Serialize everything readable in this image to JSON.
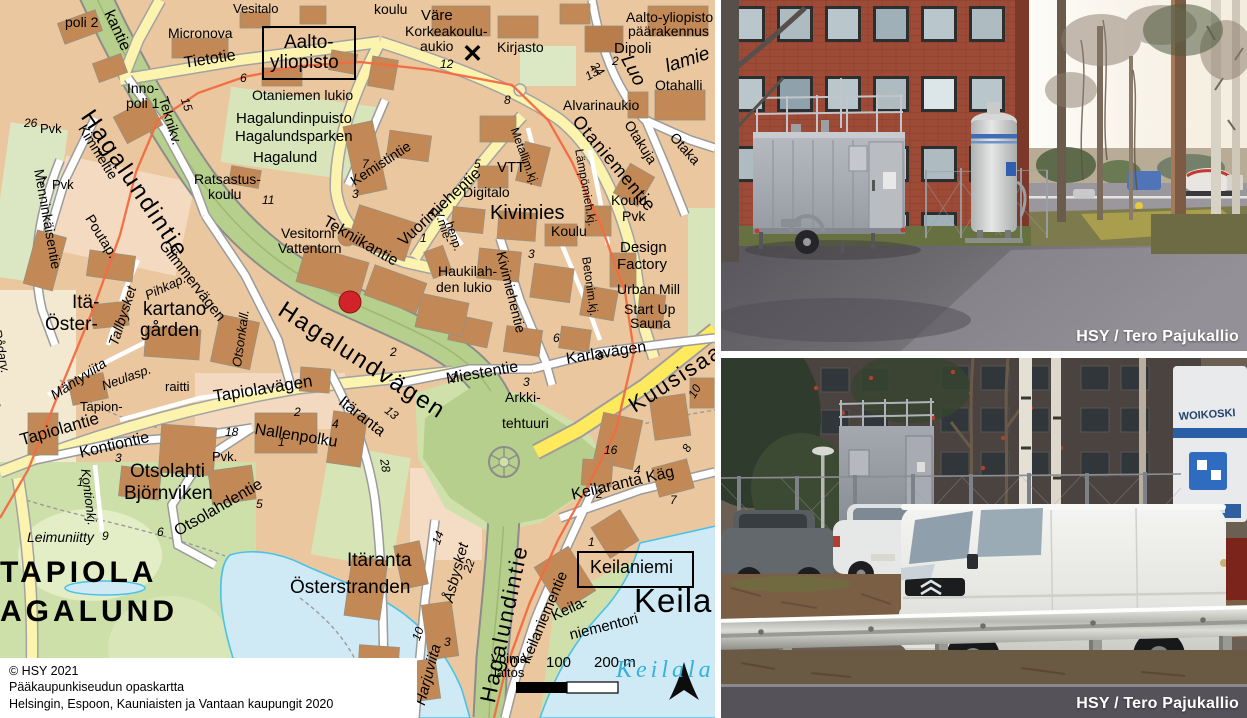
{
  "map": {
    "copyright_lines": [
      "© HSY 2021",
      "Pääkaupunkiseudun opaskartta",
      "Helsingin, Espoon, Kauniaisten ja Vantaan kaupungit 2020"
    ],
    "scale_bar": {
      "tick0": "0",
      "tick1": "100",
      "tick2": "200 m"
    },
    "marker_color": "#d2232a",
    "route_color": "#f26a41",
    "boxes": [
      {
        "x": 262,
        "y": 26,
        "w": 90,
        "h": 50
      },
      {
        "x": 577,
        "y": 551,
        "w": 113,
        "h": 33
      }
    ],
    "labels": [
      {
        "t": "poli 2",
        "x": 65,
        "y": 15,
        "s": 14
      },
      {
        "t": "Vesitalo",
        "x": 233,
        "y": 2,
        "s": 13
      },
      {
        "t": "kantie",
        "x": 115,
        "y": 8,
        "s": 16,
        "r": 65
      },
      {
        "t": "Micronova",
        "x": 168,
        "y": 26,
        "s": 14
      },
      {
        "t": "Tietotie",
        "x": 183,
        "y": 56,
        "s": 16,
        "r": -9
      },
      {
        "t": "6",
        "x": 240,
        "y": 72,
        "s": 12,
        "i": 1
      },
      {
        "t": "Aalto-",
        "x": 284,
        "y": 33,
        "s": 19
      },
      {
        "t": "yliopisto",
        "x": 270,
        "y": 53,
        "s": 19
      },
      {
        "t": "koulu",
        "x": 374,
        "y": 2,
        "s": 14
      },
      {
        "t": "Väre",
        "x": 421,
        "y": 8,
        "s": 15
      },
      {
        "t": "Korkeakoulu-",
        "x": 405,
        "y": 24,
        "s": 14
      },
      {
        "t": "aukio",
        "x": 420,
        "y": 39,
        "s": 14
      },
      {
        "t": "Kirjasto",
        "x": 497,
        "y": 40,
        "s": 14
      },
      {
        "t": "12",
        "x": 440,
        "y": 58,
        "s": 12,
        "i": 1
      },
      {
        "t": "✕",
        "x": 462,
        "y": 42,
        "s": 25,
        "b": 1
      },
      {
        "t": "Aalto-yliopisto",
        "x": 626,
        "y": 10,
        "s": 14
      },
      {
        "t": "päärakennus",
        "x": 628,
        "y": 24,
        "s": 14
      },
      {
        "t": "Dipoli",
        "x": 614,
        "y": 41,
        "s": 15
      },
      {
        "t": "Luo",
        "x": 634,
        "y": 52,
        "s": 19,
        "i": 1,
        "r": 62
      },
      {
        "t": "lamie",
        "x": 663,
        "y": 58,
        "s": 19,
        "i": 1,
        "r": -18
      },
      {
        "t": "13",
        "x": 583,
        "y": 72,
        "s": 12,
        "i": 1,
        "r": -30
      },
      {
        "t": "24",
        "x": 598,
        "y": 60,
        "s": 12,
        "i": 1,
        "r": 50
      },
      {
        "t": "2",
        "x": 612,
        "y": 55,
        "s": 12,
        "i": 1
      },
      {
        "t": "Otahalli",
        "x": 655,
        "y": 78,
        "s": 14
      },
      {
        "t": "Alvarinaukio",
        "x": 563,
        "y": 98,
        "s": 14
      },
      {
        "t": "Otaniementie",
        "x": 583,
        "y": 112,
        "s": 18,
        "r": 50,
        "ls": 1
      },
      {
        "t": "Otakuja",
        "x": 634,
        "y": 118,
        "s": 14,
        "r": 58
      },
      {
        "t": "Otaka",
        "x": 678,
        "y": 130,
        "s": 14,
        "r": 48
      },
      {
        "t": "Otaniemen lukio",
        "x": 252,
        "y": 88,
        "s": 14
      },
      {
        "t": "Hagalundinpuisto",
        "x": 236,
        "y": 111,
        "s": 15
      },
      {
        "t": "Hagalundsparken",
        "x": 235,
        "y": 129,
        "s": 15
      },
      {
        "t": "Hagalund",
        "x": 253,
        "y": 150,
        "s": 15
      },
      {
        "t": "Inno-",
        "x": 127,
        "y": 81,
        "s": 14
      },
      {
        "t": "poli 1",
        "x": 126,
        "y": 96,
        "s": 14
      },
      {
        "t": "Teknikv.",
        "x": 170,
        "y": 95,
        "s": 14,
        "r": 73
      },
      {
        "t": "15",
        "x": 190,
        "y": 96,
        "s": 12,
        "i": 1,
        "r": 70
      },
      {
        "t": "26",
        "x": 24,
        "y": 117,
        "s": 12,
        "i": 1
      },
      {
        "t": "Pvk",
        "x": 40,
        "y": 122,
        "s": 13
      },
      {
        "t": "Kimmeltie",
        "x": 88,
        "y": 122,
        "s": 14,
        "r": 58
      },
      {
        "t": "Hagalundintie",
        "x": 96,
        "y": 106,
        "s": 24,
        "r": 56,
        "ls": 2
      },
      {
        "t": "7",
        "x": 40,
        "y": 175,
        "s": 12,
        "i": 1
      },
      {
        "t": "Pvk",
        "x": 52,
        "y": 178,
        "s": 13
      },
      {
        "t": "Menninkäisentie",
        "x": 46,
        "y": 168,
        "s": 14,
        "r": 80
      },
      {
        "t": "Poutap.",
        "x": 95,
        "y": 212,
        "s": 14,
        "r": 58
      },
      {
        "t": "Glimmervägen",
        "x": 168,
        "y": 238,
        "s": 15,
        "r": 52
      },
      {
        "t": "Ratsastus-",
        "x": 194,
        "y": 172,
        "s": 14
      },
      {
        "t": "koulu",
        "x": 208,
        "y": 187,
        "s": 14
      },
      {
        "t": "11",
        "x": 262,
        "y": 194,
        "s": 12,
        "i": 1
      },
      {
        "t": "Vesitorni",
        "x": 281,
        "y": 226,
        "s": 14
      },
      {
        "t": "Vattentorn",
        "x": 278,
        "y": 241,
        "s": 14
      },
      {
        "t": "Tekniikantie",
        "x": 328,
        "y": 214,
        "s": 16,
        "r": 30
      },
      {
        "t": "Kemistintie",
        "x": 348,
        "y": 176,
        "s": 14,
        "r": -33
      },
      {
        "t": "Hagalundvägen",
        "x": 287,
        "y": 298,
        "s": 24,
        "r": 33,
        "ls": 2
      },
      {
        "t": "Itä-",
        "x": 72,
        "y": 293,
        "s": 19
      },
      {
        "t": "Öster-",
        "x": 45,
        "y": 315,
        "s": 19
      },
      {
        "t": "kartano",
        "x": 143,
        "y": 300,
        "s": 19
      },
      {
        "t": "gården",
        "x": 140,
        "y": 321,
        "s": 19
      },
      {
        "t": "Tallbysket",
        "x": 106,
        "y": 343,
        "s": 14,
        "r": -72,
        "i": 1
      },
      {
        "t": "Pihkap.",
        "x": 143,
        "y": 290,
        "s": 13,
        "r": -25,
        "i": 1
      },
      {
        "t": "Otsonkall.",
        "x": 230,
        "y": 366,
        "s": 13,
        "r": -82,
        "i": 1
      },
      {
        "t": "Rådarv.",
        "x": 3,
        "y": 328,
        "s": 13,
        "r": 78,
        "i": 1
      },
      {
        "t": "op.",
        "x": 0,
        "y": 392,
        "s": 13,
        "r": 70,
        "i": 1
      },
      {
        "t": "Mäntyviita",
        "x": 48,
        "y": 390,
        "s": 14,
        "r": -33,
        "i": 1
      },
      {
        "t": "Neulasp.",
        "x": 100,
        "y": 380,
        "s": 13,
        "r": -20,
        "i": 1
      },
      {
        "t": "Tapion-",
        "x": 80,
        "y": 400,
        "s": 13
      },
      {
        "t": "raitti",
        "x": 165,
        "y": 380,
        "s": 13
      },
      {
        "t": "Tapiolavägen",
        "x": 212,
        "y": 388,
        "s": 17,
        "r": -9
      },
      {
        "t": "Tapiolantie",
        "x": 18,
        "y": 432,
        "s": 17,
        "r": -16
      },
      {
        "t": "Kontiontie",
        "x": 78,
        "y": 446,
        "s": 16,
        "r": -13
      },
      {
        "t": "Nallenpolku",
        "x": 256,
        "y": 422,
        "s": 16,
        "r": 9
      },
      {
        "t": "2",
        "x": 294,
        "y": 406,
        "s": 12,
        "i": 1
      },
      {
        "t": "4",
        "x": 332,
        "y": 418,
        "s": 12,
        "i": 1
      },
      {
        "t": "1",
        "x": 278,
        "y": 436,
        "s": 12,
        "i": 1
      },
      {
        "t": "18",
        "x": 225,
        "y": 426,
        "s": 12,
        "i": 1
      },
      {
        "t": "Pvk.",
        "x": 212,
        "y": 450,
        "s": 13
      },
      {
        "t": "Otsolahti",
        "x": 130,
        "y": 462,
        "s": 19
      },
      {
        "t": "Björnviken",
        "x": 124,
        "y": 484,
        "s": 19
      },
      {
        "t": "3",
        "x": 115,
        "y": 452,
        "s": 12,
        "i": 1
      },
      {
        "t": "1",
        "x": 77,
        "y": 476,
        "s": 12,
        "i": 1
      },
      {
        "t": "Kontionkj.",
        "x": 92,
        "y": 468,
        "s": 13,
        "r": 83,
        "i": 1
      },
      {
        "t": "6",
        "x": 157,
        "y": 526,
        "s": 12,
        "i": 1
      },
      {
        "t": "9",
        "x": 102,
        "y": 530,
        "s": 12,
        "i": 1
      },
      {
        "t": "5",
        "x": 256,
        "y": 498,
        "s": 12,
        "i": 1
      },
      {
        "t": "Otsolahdentie",
        "x": 172,
        "y": 526,
        "s": 16,
        "r": -30
      },
      {
        "t": "Leimuniitty",
        "x": 27,
        "y": 530,
        "s": 14,
        "i": 1
      },
      {
        "t": "TAPIOLA",
        "x": 0,
        "y": 558,
        "s": 30,
        "b": 1,
        "ls": 4
      },
      {
        "t": "AGALUND",
        "x": 0,
        "y": 597,
        "s": 30,
        "b": 1,
        "ls": 4
      },
      {
        "t": "VTT",
        "x": 497,
        "y": 160,
        "s": 15
      },
      {
        "t": "Metallim.kj.",
        "x": 520,
        "y": 126,
        "s": 12,
        "r": 70
      },
      {
        "t": "Lämpömieh.kj.",
        "x": 585,
        "y": 148,
        "s": 12,
        "r": 80
      },
      {
        "t": "Vuorimiehentie",
        "x": 396,
        "y": 238,
        "s": 16,
        "r": -43
      },
      {
        "t": "V.mie-",
        "x": 444,
        "y": 208,
        "s": 12,
        "r": 72
      },
      {
        "t": "henp.",
        "x": 455,
        "y": 220,
        "s": 12,
        "r": 72
      },
      {
        "t": "Digitalo",
        "x": 463,
        "y": 185,
        "s": 14
      },
      {
        "t": "Kivimies",
        "x": 490,
        "y": 203,
        "s": 20
      },
      {
        "t": "Koulu",
        "x": 551,
        "y": 224,
        "s": 14
      },
      {
        "t": "Koulu",
        "x": 611,
        "y": 193,
        "s": 14
      },
      {
        "t": "Pvk",
        "x": 622,
        "y": 209,
        "s": 14
      },
      {
        "t": "Design",
        "x": 620,
        "y": 240,
        "s": 15
      },
      {
        "t": "Factory",
        "x": 617,
        "y": 257,
        "s": 15
      },
      {
        "t": "Urban Mill",
        "x": 617,
        "y": 282,
        "s": 14
      },
      {
        "t": "Start Up",
        "x": 624,
        "y": 302,
        "s": 14
      },
      {
        "t": "Sauna",
        "x": 630,
        "y": 316,
        "s": 14
      },
      {
        "t": "Haukilah-",
        "x": 438,
        "y": 264,
        "s": 14
      },
      {
        "t": "den lukio",
        "x": 436,
        "y": 280,
        "s": 14
      },
      {
        "t": "Kivimiehentie",
        "x": 508,
        "y": 250,
        "s": 14,
        "r": 76
      },
      {
        "t": "Betonim.kj.",
        "x": 592,
        "y": 256,
        "s": 12,
        "r": 82
      },
      {
        "t": "4",
        "x": 428,
        "y": 206,
        "s": 12,
        "i": 1
      },
      {
        "t": "1",
        "x": 420,
        "y": 232,
        "s": 12,
        "i": 1
      },
      {
        "t": "5",
        "x": 474,
        "y": 158,
        "s": 12,
        "i": 1
      },
      {
        "t": "3",
        "x": 528,
        "y": 248,
        "s": 12,
        "i": 1
      },
      {
        "t": "8",
        "x": 504,
        "y": 94,
        "s": 12,
        "i": 1
      },
      {
        "t": "3",
        "x": 352,
        "y": 188,
        "s": 12,
        "i": 1
      },
      {
        "t": "7",
        "x": 362,
        "y": 158,
        "s": 12,
        "i": 1
      },
      {
        "t": "2",
        "x": 390,
        "y": 346,
        "s": 12,
        "i": 1
      },
      {
        "t": "6",
        "x": 553,
        "y": 332,
        "s": 12,
        "i": 1
      },
      {
        "t": "2",
        "x": 450,
        "y": 372,
        "s": 12,
        "i": 1
      },
      {
        "t": "3",
        "x": 523,
        "y": 376,
        "s": 12,
        "i": 1
      },
      {
        "t": "9",
        "x": 597,
        "y": 350,
        "s": 12,
        "i": 1
      },
      {
        "t": "Miestentie",
        "x": 445,
        "y": 372,
        "s": 16,
        "r": -10
      },
      {
        "t": "Karlavägen",
        "x": 565,
        "y": 352,
        "s": 16,
        "r": -9
      },
      {
        "t": "Kuusisaarentie",
        "x": 625,
        "y": 398,
        "s": 22,
        "r": -33,
        "ls": 2
      },
      {
        "t": "Arkki-",
        "x": 505,
        "y": 390,
        "s": 14
      },
      {
        "t": "tehtuuri",
        "x": 502,
        "y": 416,
        "s": 14
      },
      {
        "t": "Itäranta",
        "x": 345,
        "y": 394,
        "s": 16,
        "r": 38
      },
      {
        "t": "13",
        "x": 390,
        "y": 404,
        "s": 12,
        "i": 1,
        "r": 38
      },
      {
        "t": "28",
        "x": 390,
        "y": 458,
        "s": 12,
        "i": 1,
        "r": 80
      },
      {
        "t": "Keilaranta Käg",
        "x": 570,
        "y": 488,
        "s": 16,
        "r": -13
      },
      {
        "t": "16",
        "x": 604,
        "y": 444,
        "s": 12,
        "i": 1
      },
      {
        "t": "4",
        "x": 634,
        "y": 464,
        "s": 12,
        "i": 1
      },
      {
        "t": "2",
        "x": 596,
        "y": 488,
        "s": 12,
        "i": 1
      },
      {
        "t": "8",
        "x": 680,
        "y": 448,
        "s": 12,
        "i": 1,
        "r": -60
      },
      {
        "t": "10",
        "x": 686,
        "y": 394,
        "s": 12,
        "i": 1,
        "r": -60
      },
      {
        "t": "7",
        "x": 670,
        "y": 494,
        "s": 12,
        "i": 1
      },
      {
        "t": "Itäranta",
        "x": 347,
        "y": 551,
        "s": 19
      },
      {
        "t": "Österstranden",
        "x": 290,
        "y": 578,
        "s": 19
      },
      {
        "t": "Harjuviita",
        "x": 413,
        "y": 703,
        "s": 15,
        "r": -75,
        "i": 1
      },
      {
        "t": "Åsbysket",
        "x": 441,
        "y": 600,
        "s": 15,
        "r": -75,
        "i": 1
      },
      {
        "t": "14",
        "x": 430,
        "y": 542,
        "s": 12,
        "i": 1,
        "r": -70
      },
      {
        "t": "22",
        "x": 461,
        "y": 570,
        "s": 12,
        "i": 1,
        "r": -70
      },
      {
        "t": "10",
        "x": 410,
        "y": 638,
        "s": 12,
        "i": 1,
        "r": -70
      },
      {
        "t": "3",
        "x": 444,
        "y": 636,
        "s": 12,
        "i": 1
      },
      {
        "t": "18",
        "x": 374,
        "y": 656,
        "s": 12,
        "i": 1,
        "r": 80
      },
      {
        "t": "1",
        "x": 588,
        "y": 536,
        "s": 12,
        "i": 1
      },
      {
        "t": "Hagalundintie",
        "x": 477,
        "y": 700,
        "s": 22,
        "r": -78,
        "ls": 2
      },
      {
        "t": "Keilaniementie",
        "x": 518,
        "y": 660,
        "s": 15,
        "r": -67
      },
      {
        "t": "Keilaniemi",
        "x": 590,
        "y": 558,
        "s": 18
      },
      {
        "t": "Keila",
        "x": 634,
        "y": 584,
        "s": 33,
        "ls": 1
      },
      {
        "t": "Keila-",
        "x": 549,
        "y": 610,
        "s": 15,
        "r": -25
      },
      {
        "t": "niementori",
        "x": 568,
        "y": 628,
        "s": 15,
        "r": -14
      },
      {
        "t": "Voima-",
        "x": 491,
        "y": 652,
        "s": 13
      },
      {
        "t": "laitos",
        "x": 494,
        "y": 666,
        "s": 13
      },
      {
        "t": "0",
        "x": 510,
        "y": 655,
        "s": 15
      },
      {
        "t": "100",
        "x": 546,
        "y": 655,
        "s": 15
      },
      {
        "t": "200 m",
        "x": 594,
        "y": 655,
        "s": 15
      },
      {
        "t": "Keilalahti",
        "x": 616,
        "y": 658,
        "s": 24,
        "i": 1,
        "f": 1,
        "ls": 4,
        "c": "#35b2dc"
      }
    ]
  },
  "photos": {
    "top": {
      "credit": "HSY / Tero Pajukallio"
    },
    "bottom": {
      "credit": "HSY / Tero Pajukallio",
      "truck_text": "WOIKOSKI"
    }
  }
}
